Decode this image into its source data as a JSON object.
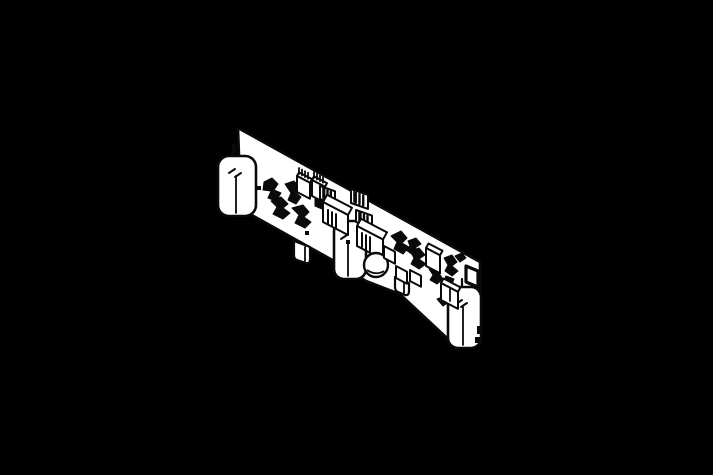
{
  "canvas": {
    "width": 713,
    "height": 475,
    "background": "#000000"
  },
  "drawing": {
    "stroke_color": "#0a0a0a",
    "fill_color": "#ffffff",
    "subject": "isometric-pcb-line-drawing",
    "primitives": [
      {
        "t": "path",
        "n": "pcb-board",
        "d": "M238,128 L480,262 L480,344 L465,341 L447,338 L403,297 L397,293 L366,281 L336,262 L241,209 Z",
        "f": "#ffffff",
        "w": 2.6
      },
      {
        "t": "path",
        "n": "mounting-tab",
        "d": "M294,241 L310,247 L310,259 Q310,264 306,263 L297,260 Q294,259 294,255 Z",
        "f": "#ffffff",
        "w": 2.2
      },
      {
        "t": "line",
        "n": "mounting-tab-line",
        "x1": 305,
        "y1": 247,
        "x2": 305,
        "y2": 261,
        "w": 1.8
      },
      {
        "t": "path",
        "n": "mounting-tab",
        "d": "M395,277 L409,283 L409,291 Q409,296 405,295 L398,292 Q395,291 395,287 Z",
        "f": "#ffffff",
        "w": 2.2
      },
      {
        "t": "line",
        "n": "mounting-tab-line",
        "x1": 404,
        "y1": 282,
        "x2": 404,
        "y2": 294,
        "w": 1.8
      },
      {
        "t": "cap",
        "n": "capacitor-cylinder",
        "x": 218,
        "y": 156,
        "wd": 38,
        "h": 60,
        "rx": 11,
        "seam": [
          236,
          176,
          213
        ],
        "lead": [
          233,
          147,
          157
        ],
        "ticks": [
          [
            229,
            173,
            235,
            169
          ],
          [
            235,
            177,
            241,
            173
          ]
        ]
      },
      {
        "t": "cap",
        "n": "capacitor-cylinder",
        "x": 334,
        "y": 221,
        "wd": 32,
        "h": 58,
        "rx": 10,
        "seam": [
          348,
          241,
          276
        ],
        "lead": [
          346,
          212,
          222
        ],
        "ticks": [
          [
            341,
            239,
            347,
            235
          ]
        ]
      },
      {
        "t": "cap",
        "n": "capacitor-cylinder",
        "x": 448,
        "y": 287,
        "wd": 33,
        "h": 61,
        "rx": 10,
        "seam": [
          463,
          307,
          345
        ],
        "lead": [
          462,
          279,
          288
        ],
        "ticks": [
          [
            456,
            304,
            462,
            300
          ],
          [
            461,
            307,
            467,
            303
          ]
        ]
      },
      {
        "t": "poly",
        "n": "component-silhouette",
        "pts": "264,182 272,178 278,184 274,190 281,193 276,201 268,198 271,191 263,190"
      },
      {
        "t": "poly",
        "n": "component-silhouette",
        "pts": "271,201 281,197 288,204 283,208 290,213 283,219 273,214 277,207"
      },
      {
        "t": "poly",
        "n": "component-silhouette",
        "pts": "285,184 294,181 300,188 295,192 301,197 296,204 288,200 291,193"
      },
      {
        "t": "poly",
        "n": "component-silhouette",
        "pts": "292,208 303,205 309,212 304,217 311,222 305,228 295,223 299,215"
      },
      {
        "t": "poly",
        "n": "component-silhouette",
        "pts": "303,186 312,184 316,190 310,195 303,192"
      },
      {
        "t": "poly",
        "n": "component-silhouette",
        "pts": "315,198 323,196 328,203 322,209 315,206"
      },
      {
        "t": "poly",
        "n": "component-silhouette",
        "pts": "391,236 401,231 407,238 402,243 409,247 403,254 394,249 397,242"
      },
      {
        "t": "poly",
        "n": "component-silhouette",
        "pts": "408,241 416,238 421,244 415,248 419,252 413,255 406,250 410,246"
      },
      {
        "t": "poly",
        "n": "component-silhouette",
        "pts": "410,251 419,248 425,255 419,259 426,264 419,269 411,264 414,258"
      },
      {
        "t": "poly",
        "n": "component-silhouette",
        "pts": "444,258 452,255 457,262 452,266 458,271 452,276 445,271 448,265"
      },
      {
        "t": "poly",
        "n": "component-silhouette",
        "pts": "446,276 454,279 451,287 443,283"
      },
      {
        "t": "poly",
        "n": "component-silhouette",
        "pts": "429,269 438,272 443,279 437,284 430,280 433,275"
      },
      {
        "t": "poly",
        "n": "component-silhouette",
        "pts": "455,256 462,253 466,258 460,262"
      },
      {
        "t": "poly",
        "n": "component-silhouette",
        "pts": "437,299 445,296 449,302 443,306"
      },
      {
        "t": "rect",
        "n": "solder-dot",
        "x": 257,
        "y": 186,
        "wd": 4,
        "h": 4
      },
      {
        "t": "rect",
        "n": "solder-dot",
        "x": 305,
        "y": 231,
        "wd": 4,
        "h": 4
      },
      {
        "t": "rect",
        "n": "solder-dot",
        "x": 346,
        "y": 240,
        "wd": 4,
        "h": 4
      },
      {
        "t": "rect",
        "n": "solder-dot",
        "x": 369,
        "y": 237,
        "wd": 4,
        "h": 4
      },
      {
        "t": "rect",
        "n": "edge-hole",
        "x": 232,
        "y": 144,
        "wd": 4,
        "h": 9
      },
      {
        "t": "ibox",
        "n": "ic-box",
        "x": 297,
        "y": 176,
        "wd": 13,
        "h": 16,
        "d": 4,
        "pins": {
          "x": 299,
          "y": 174,
          "n": 4,
          "dx": 3,
          "len": 6
        }
      },
      {
        "t": "ibox",
        "n": "ic-box",
        "x": 312,
        "y": 180,
        "wd": 13,
        "h": 16,
        "d": 4,
        "pins": {
          "x": 314,
          "y": 178,
          "n": 4,
          "dx": 3,
          "len": 6
        }
      },
      {
        "t": "hcap",
        "n": "striped-connector",
        "x": 320,
        "y": 186,
        "wd": 15,
        "h": 13
      },
      {
        "t": "ibox",
        "n": "connector-box",
        "x": 323,
        "y": 202,
        "wd": 25,
        "h": 20,
        "d": 8,
        "hatch": {
          "x": 328,
          "y": 210,
          "n": 3,
          "dx": 4,
          "len": 14
        }
      },
      {
        "t": "hcap",
        "n": "striped-connector",
        "x": 351,
        "y": 189,
        "wd": 17,
        "h": 14
      },
      {
        "t": "hcap",
        "n": "striped-connector",
        "x": 356,
        "y": 210,
        "wd": 16,
        "h": 12
      },
      {
        "t": "ibox",
        "n": "connector-box",
        "x": 357,
        "y": 226,
        "wd": 26,
        "h": 20,
        "d": 8,
        "hatch": {
          "x": 362,
          "y": 233,
          "n": 3,
          "dx": 4,
          "len": 14
        }
      },
      {
        "t": "circ",
        "n": "round-component",
        "cx": 376,
        "cy": 265,
        "r": 12
      },
      {
        "t": "ibox",
        "n": "ic-box",
        "x": 384,
        "y": 246,
        "wd": 11,
        "h": 12,
        "d": 0
      },
      {
        "t": "ibox",
        "n": "ic-box",
        "x": 396,
        "y": 266,
        "wd": 11,
        "h": 12,
        "d": 0
      },
      {
        "t": "ibox",
        "n": "ic-box",
        "x": 410,
        "y": 270,
        "wd": 11,
        "h": 11,
        "d": 0
      },
      {
        "t": "ibox",
        "n": "ic-box",
        "x": 426,
        "y": 248,
        "wd": 14,
        "h": 18,
        "d": 5
      },
      {
        "t": "ibox",
        "n": "ic-box",
        "x": 441,
        "y": 283,
        "wd": 17,
        "h": 17,
        "d": 5
      },
      {
        "t": "line",
        "n": "ic-box-line",
        "x1": 450,
        "y1": 289,
        "x2": 450,
        "y2": 301,
        "w": 1.8
      },
      {
        "t": "path",
        "n": "frame-component",
        "d": "M466,266 L478,271 L478,287 L466,282 Z",
        "f": "#ffffff",
        "w": 3.2
      },
      {
        "t": "rect",
        "n": "edge-slot",
        "x": 477,
        "y": 326,
        "wd": 5,
        "h": 8
      },
      {
        "t": "rect",
        "n": "edge-slot",
        "x": 475,
        "y": 337,
        "wd": 7,
        "h": 6
      }
    ]
  }
}
